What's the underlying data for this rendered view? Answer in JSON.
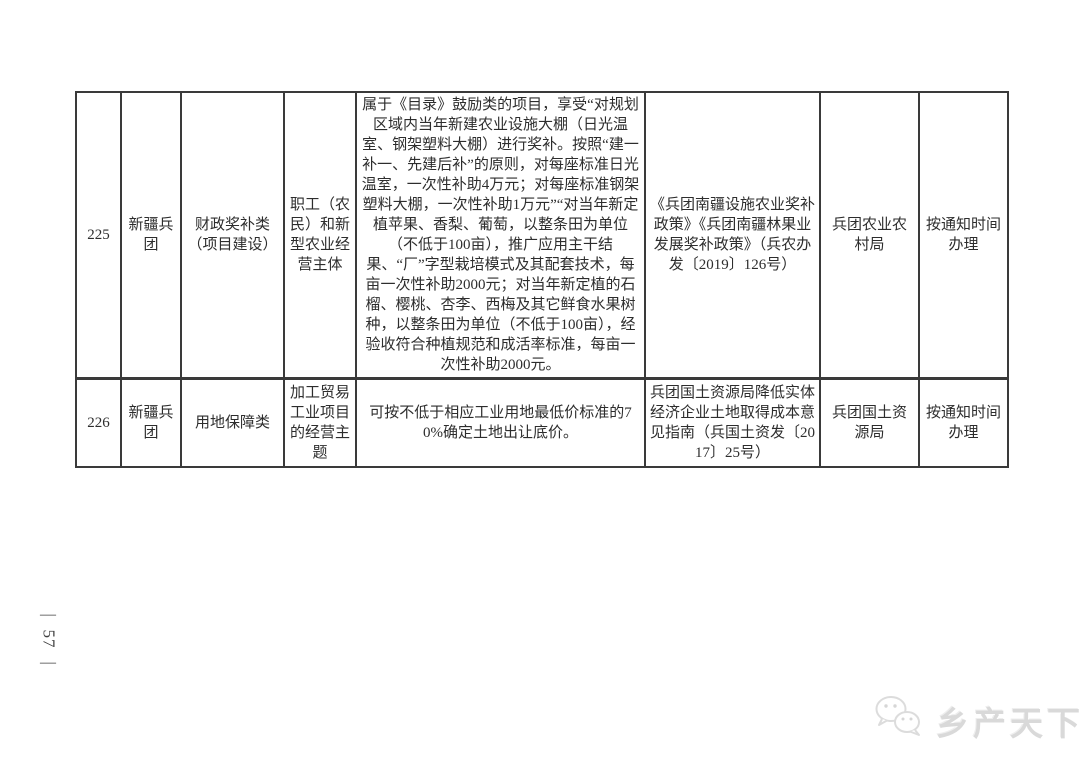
{
  "page": {
    "side_page_number": {
      "dash": "—",
      "number": "57"
    }
  },
  "watermark": {
    "icon": "wechat-chat-bubbles-icon",
    "text": "乡产天下",
    "color": "#d9d9d9"
  },
  "colors": {
    "table_border": "#3a3a3a",
    "body_text": "#2d2d2d",
    "watermark": "#d9d9d9"
  },
  "table": {
    "rows": [
      {
        "id": "225",
        "region": "新疆兵团",
        "category": "财政奖补类（项目建设）",
        "subject": "职工（农民）和新型农业经营主体",
        "content": "属于《目录》鼓励类的项目，享受“对规划区域内当年新建农业设施大棚（日光温室、钢架塑料大棚）进行奖补。按照“建一补一、先建后补”的原则，对每座标准日光温室，一次性补助4万元；对每座标准钢架塑料大棚，一次性补助1万元”“对当年新定植苹果、香梨、葡萄，以整条田为单位（不低于100亩），推广应用主干结果、“厂”字型栽培模式及其配套技术，每亩一次性补助2000元；对当年新定植的石榴、樱桃、杏李、西梅及其它鲜食水果树种，以整条田为单位（不低于100亩），经验收符合种植规范和成活率标准，每亩一次性补助2000元。",
        "policy": "《兵团南疆设施农业奖补政策》《兵团南疆林果业发展奖补政策》（兵农办发〔2019〕126号）",
        "department": "兵团农业农村局",
        "schedule": "按通知时间办理"
      },
      {
        "id": "226",
        "region": "新疆兵团",
        "category": "用地保障类",
        "subject": "加工贸易工业项目的经营主题",
        "content": "可按不低于相应工业用地最低价标准的70%确定土地出让底价。",
        "policy": "兵团国土资源局降低实体经济企业土地取得成本意见指南（兵国土资发〔2017〕25号）",
        "department": "兵团国土资源局",
        "schedule": "按通知时间办理"
      }
    ]
  }
}
